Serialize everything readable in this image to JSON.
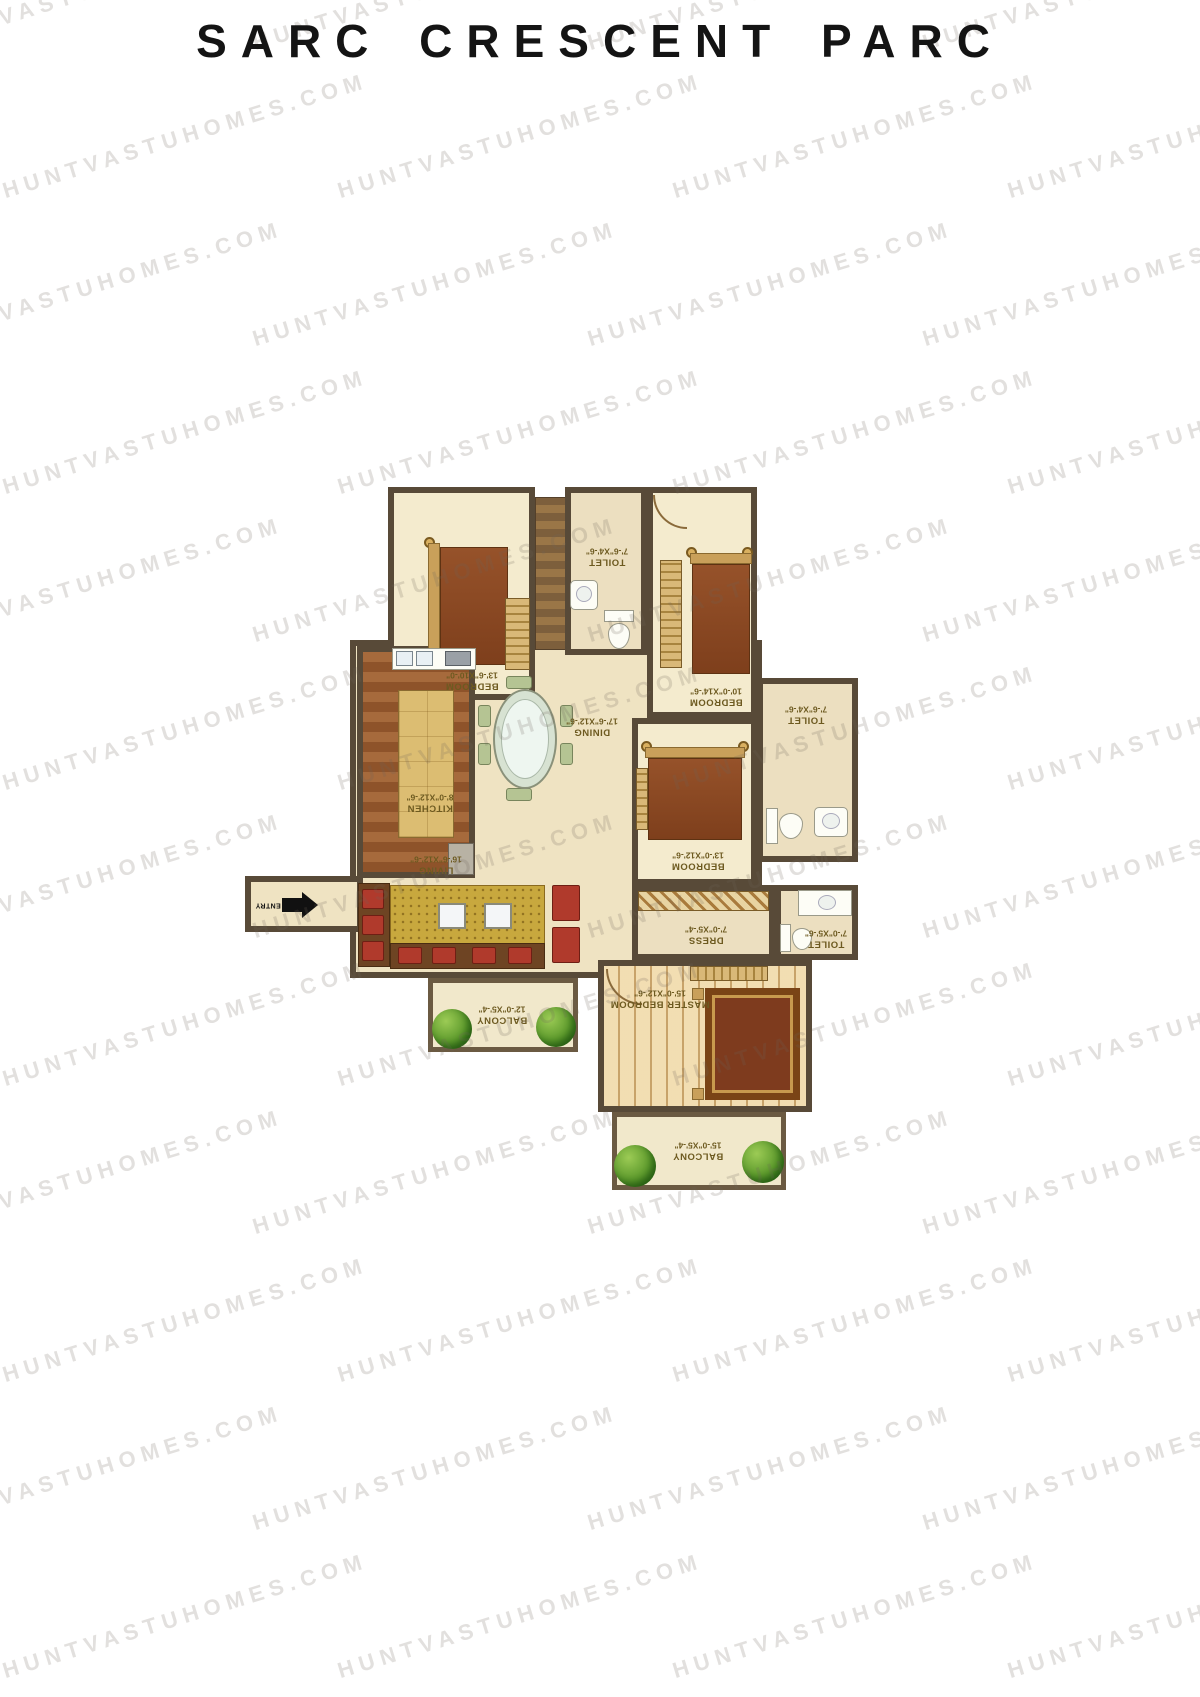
{
  "title": "SARC CRESCENT PARC",
  "watermark": {
    "text": "HUNTVASTUHOMES.COM"
  },
  "plan": {
    "colors": {
      "wall": "#584a38",
      "room_floor": "#f4ebce",
      "hall_floor": "#efe3c2",
      "kitchen_floor": "#9a5a2e",
      "wood_floor": "#e3c28a",
      "label_text": "#6d5a20",
      "bush_green": "#5d9a2c",
      "bed_brown": "#8a4a26"
    },
    "rooms": {
      "bedroom1": {
        "name": "BEDROOM",
        "dims": "13'-6\"X10'-0\""
      },
      "toilet1": {
        "name": "TOILET",
        "dims": "7'-6\"X4'-6\""
      },
      "bedroom2": {
        "name": "BEDROOM",
        "dims": "10'-0\"X14'-6\""
      },
      "toilet2": {
        "name": "TOILET",
        "dims": "7'-6\"X4'-6\""
      },
      "kitchen": {
        "name": "KITCHEN",
        "dims": "8'-0\"X12'-6\""
      },
      "dining": {
        "name": "DINING",
        "dims": "17'-6\"X12'-6\""
      },
      "bedroom3": {
        "name": "BEDROOM",
        "dims": "13'-0\"X12'-6\""
      },
      "dress": {
        "name": "DRESS",
        "dims": "7'-0\"X5'-4\""
      },
      "toilet3": {
        "name": "TOILET",
        "dims": "7'-0\"X5'-6\""
      },
      "living": {
        "name": "LIVING",
        "dims": "16'-6\"X12'-6\""
      },
      "master": {
        "name": "MASTER BEDROOM",
        "dims": "15'-0\"X12'-6\""
      },
      "balcony1": {
        "name": "BALCONY",
        "dims": "12'-0\"X5'-4\""
      },
      "balcony2": {
        "name": "BALCONY",
        "dims": "15'-0\"X5'-4\""
      }
    },
    "entry": {
      "label": "ENTRY"
    }
  }
}
